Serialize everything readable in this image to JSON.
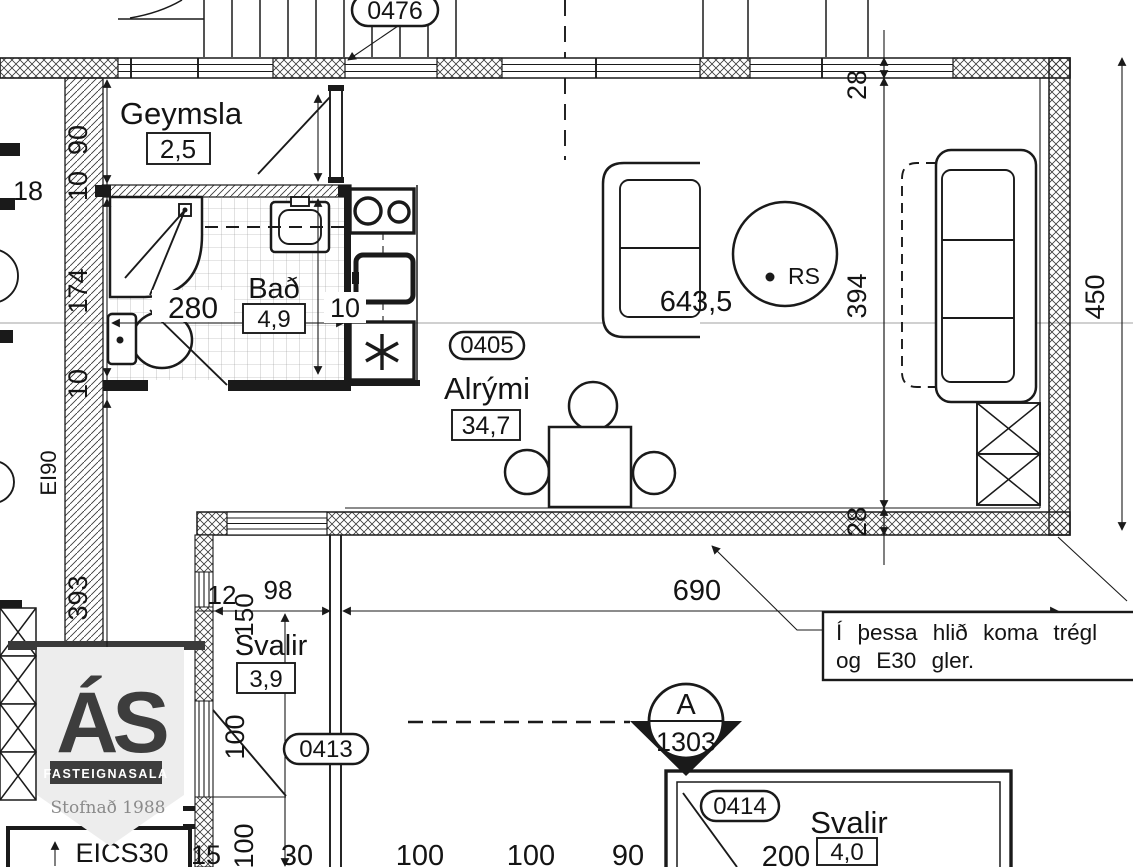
{
  "drawing": {
    "rooms": [
      {
        "name": "Geymsla",
        "area": "2,5"
      },
      {
        "name": "Bað",
        "area": "4,9"
      },
      {
        "name": "Alrými",
        "area": "34,7"
      },
      {
        "name": "Svalir",
        "area": "3,9"
      },
      {
        "name": "Svalir",
        "area": "4,0"
      }
    ],
    "tags": {
      "stairwell": "0476",
      "alrymi": "0405",
      "svalir_small": "0413",
      "svalir_bottom": "0414"
    },
    "note": {
      "line1": "Í þessa hlið koma trégl",
      "line2": "og E30 gler."
    },
    "section_marker": {
      "letter": "A",
      "number": "1303"
    },
    "symbols": {
      "smoke_detector": "RS",
      "fire_rating_wall": "EI90",
      "fire_rating_window": "EICS30"
    },
    "dims": {
      "left_18": "18",
      "left_90": "90",
      "left_10_upper": "10",
      "left_174": "174",
      "left_10_lower": "10",
      "left_393": "393",
      "bath_280": "280",
      "bath_10": "10",
      "sofa_643": "643,5",
      "right_28_top": "28",
      "right_394": "394",
      "right_28_bottom": "28",
      "right_450": "450",
      "bottom_690": "690",
      "svalir_12": "12",
      "svalir_98": "98",
      "svalir_150": "150",
      "svalir_100_upper": "100",
      "svalir_100_lower": "100",
      "edge_15": "15",
      "edge_30": "30",
      "edge_100_a": "100",
      "edge_100_b": "100",
      "edge_90": "90",
      "edge_200": "200"
    },
    "logo": {
      "monogram": "ÁS",
      "name": "FASTEIGNASALA",
      "tagline": "Stofnað 1988"
    },
    "colors": {
      "ink": "#1a1a1a",
      "logo_gray": "#3d3d3d",
      "pennant": "#ededed",
      "centerline_gray": "#b3b3b3"
    }
  }
}
